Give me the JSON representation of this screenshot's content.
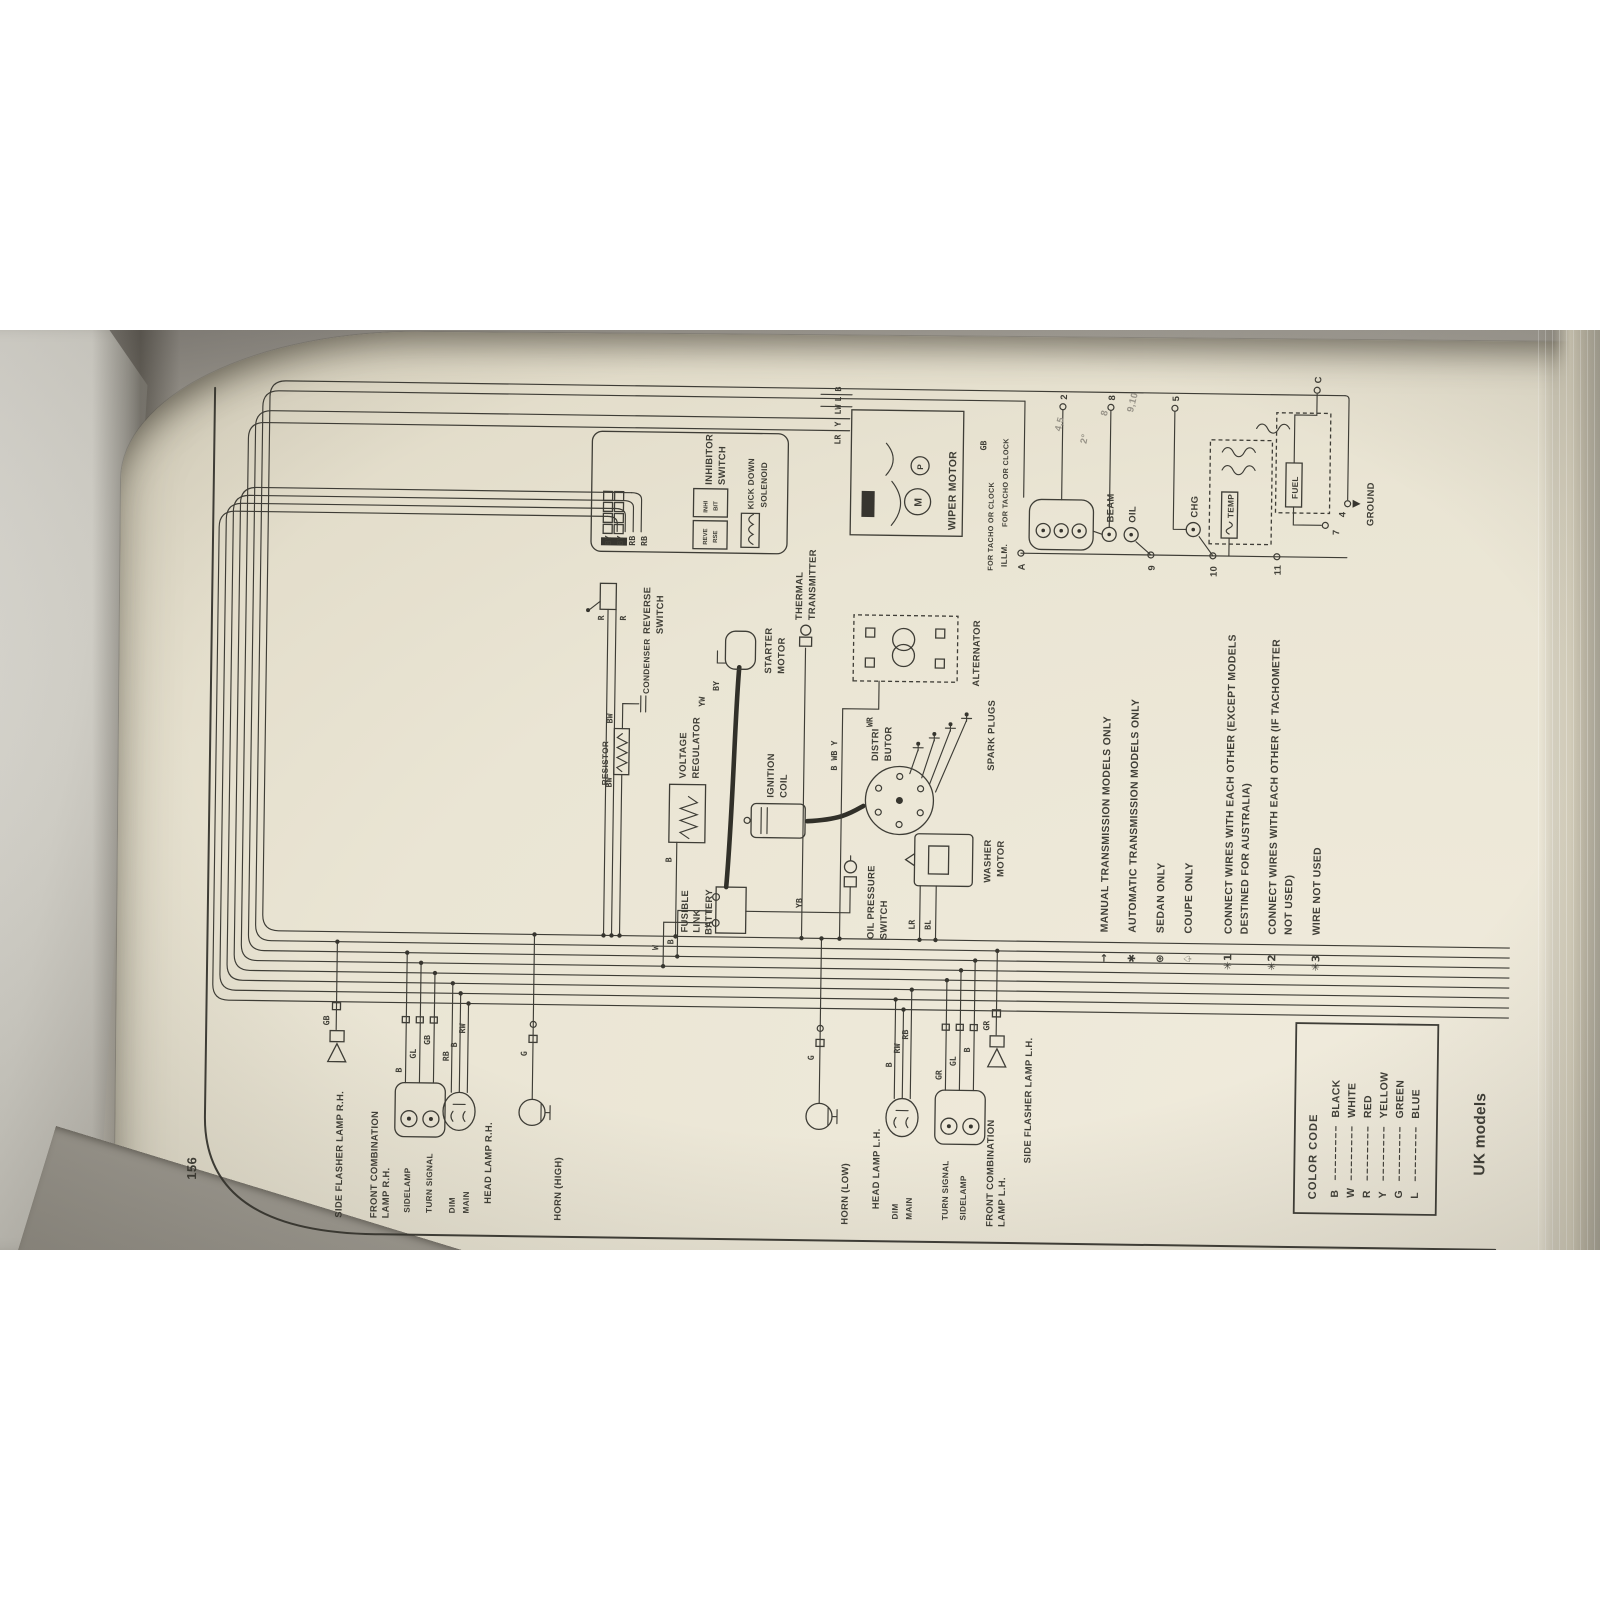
{
  "page": {
    "number": "156",
    "footer": "UK models"
  },
  "labels": {
    "side_flasher_rh": [
      "SIDE FLASHER LAMP R.H."
    ],
    "front_comb_rh": [
      "FRONT COMBINATION",
      "LAMP R.H."
    ],
    "sidelamp_rh": [
      "SIDELAMP"
    ],
    "turn_signal_rh": [
      "TURN SIGNAL"
    ],
    "dim_rh": [
      "DIM"
    ],
    "main_rh": [
      "MAIN"
    ],
    "head_lamp_rh": [
      "HEAD LAMP R.H."
    ],
    "horn_high": [
      "HORN (HIGH)"
    ],
    "horn_low": [
      "HORN (LOW)"
    ],
    "head_lamp_lh": [
      "HEAD LAMP L.H."
    ],
    "dim_lh": [
      "DIM"
    ],
    "main_lh": [
      "MAIN"
    ],
    "turn_signal_lh": [
      "TURN SIGNAL"
    ],
    "sidelamp_lh": [
      "SIDELAMP"
    ],
    "front_comb_lh": [
      "FRONT COMBINATION",
      "LAMP L.H."
    ],
    "side_flasher_lh": [
      "SIDE FLASHER LAMP L.H."
    ],
    "fusible_link": [
      "FUSIBLE",
      "LINK"
    ],
    "battery": [
      "BATTERY"
    ],
    "battery_plus": "+",
    "voltage_regulator": [
      "VOLTAGE",
      "REGULATOR"
    ],
    "ignition_coil": [
      "IGNITION",
      "COIL"
    ],
    "resistor": [
      "RESISTOR"
    ],
    "condenser": [
      "CONDENSER"
    ],
    "distributor": [
      "DISTRI",
      "BUTOR"
    ],
    "spark_plugs": [
      "SPARK PLUGS"
    ],
    "starter_motor": [
      "STARTER",
      "MOTOR"
    ],
    "thermal_transmitter": [
      "THERMAL",
      "TRANSMITTER"
    ],
    "alternator": [
      "ALTERNATOR"
    ],
    "oil_pressure_switch": [
      "OIL PRESSURE",
      "SWITCH"
    ],
    "washer_motor": [
      "WASHER",
      "MOTOR"
    ],
    "reverse_switch": [
      "REVERSE",
      "SWITCH"
    ],
    "inhibitor_switch": [
      "INHIBITOR",
      "SWITCH"
    ],
    "inhibitor_pins": [
      "REVE",
      "RSE",
      "INHI",
      "BIT"
    ],
    "kick_down_solenoid": [
      "KICK DOWN",
      "SOLENOID"
    ],
    "wiper_motor": [
      "WIPER MOTOR"
    ],
    "wiper_letters": [
      "M",
      "P"
    ]
  },
  "wires": {
    "flasher_rh": "GB",
    "comb_rh": [
      "B",
      "GL",
      "GB"
    ],
    "head_rh": [
      "RB",
      "B",
      "RW"
    ],
    "horn_high": "G",
    "horn_low": "G",
    "head_lh": [
      "B",
      "RW",
      "RB"
    ],
    "comb_lh": [
      "GR",
      "GL",
      "B"
    ],
    "flasher_lh": "GR",
    "battery": [
      "W",
      "B"
    ],
    "regulator": "B",
    "resistor": [
      "BW",
      "BW"
    ],
    "oil_switch": "YB",
    "washer": [
      "LR",
      "BL"
    ],
    "starter": [
      "YW",
      "BY"
    ],
    "alternator": [
      "B WB Y",
      "WR"
    ],
    "reverse": [
      "R",
      "R"
    ],
    "inhibitor": [
      "BY",
      "BY",
      "RB",
      "RB"
    ],
    "wiper": [
      "LR",
      "Y",
      "LW",
      "L",
      "B"
    ],
    "cluster_top": "GB"
  },
  "cluster": {
    "headers": [
      "FOR TACHO OR CLOCK",
      "ILLM.",
      "FOR TACHO OR CLOCK"
    ],
    "lamps": [
      "BEAM",
      "OIL",
      "CHG"
    ],
    "gauges": [
      "TEMP",
      "FUEL"
    ],
    "terminals": [
      "A",
      "2",
      "8",
      "5",
      "9",
      "10",
      "11",
      "7",
      "4",
      "C"
    ],
    "ground": "GROUND"
  },
  "notes": {
    "n1_sym": "→",
    "n1": "MANUAL TRANSMISSION MODELS ONLY",
    "n2_sym": "✱",
    "n2": "AUTOMATIC TRANSMISSION MODELS ONLY",
    "n3_sym": "⊛",
    "n3": "SEDAN ONLY",
    "n4_sym": "♤",
    "n4": "COUPE ONLY",
    "n5_sym": "✳1",
    "n5a": "CONNECT WIRES WITH EACH OTHER (EXCEPT MODELS",
    "n5b": "DESTINED FOR AUSTRALIA)",
    "n6_sym": "✳2",
    "n6a": "CONNECT WIRES WITH EACH OTHER (IF TACHOMETER",
    "n6b": "NOT USED)",
    "n7_sym": "✳3",
    "n7": "WIRE NOT USED"
  },
  "color_code": {
    "title": "COLOR CODE",
    "entries": [
      {
        "code": "B",
        "name": "BLACK"
      },
      {
        "code": "W",
        "name": "WHITE"
      },
      {
        "code": "R",
        "name": "RED"
      },
      {
        "code": "Y",
        "name": "YELLOW"
      },
      {
        "code": "G",
        "name": "GREEN"
      },
      {
        "code": "L",
        "name": "BLUE"
      }
    ]
  },
  "annotations": [
    "4,5",
    "2°",
    "8",
    "9,10"
  ]
}
